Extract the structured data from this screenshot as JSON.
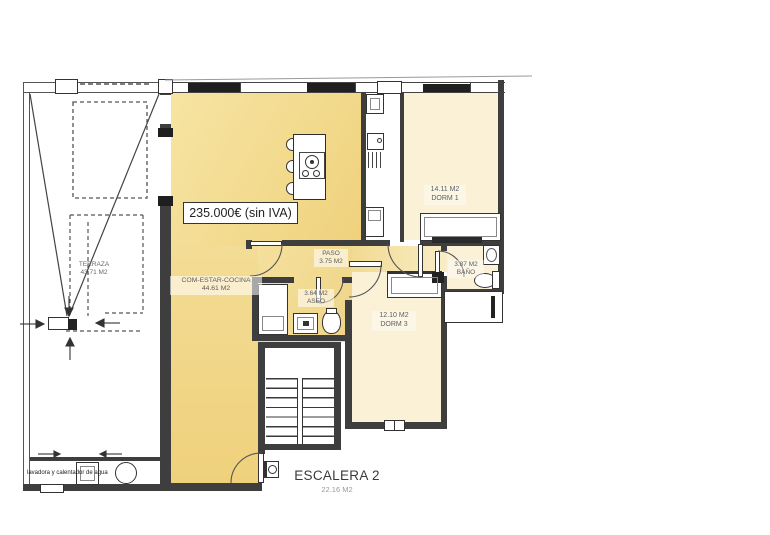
{
  "price_label": "235.000€ (sin IVA)",
  "rooms": {
    "terraza": {
      "name": "TERRAZA",
      "area": "43.71 M2"
    },
    "salon": {
      "name": "COM-ESTAR-COCINA",
      "area": "44.61 M2"
    },
    "paso": {
      "name": "PASO",
      "area": "3.75 M2"
    },
    "aseo": {
      "name": "ASEO",
      "area": "3.64 M2"
    },
    "dorm1": {
      "name": "DORM 1",
      "area": "14.11 M2"
    },
    "bano": {
      "name": "BAÑO",
      "area": "3.87 M2"
    },
    "dorm3": {
      "name": "DORM 3",
      "area": "12.10 M2"
    },
    "escalera": {
      "name": "ESCALERA 2",
      "area": "22.16 M2"
    }
  },
  "notes": {
    "utility": "lavadora y calentador de agua"
  },
  "colors": {
    "living": "#F2D98C",
    "living_light": "#F7E5A4",
    "bedroom": "#FAF1D6",
    "wall": "#3E3E3E",
    "window": "#1F1F1F"
  }
}
